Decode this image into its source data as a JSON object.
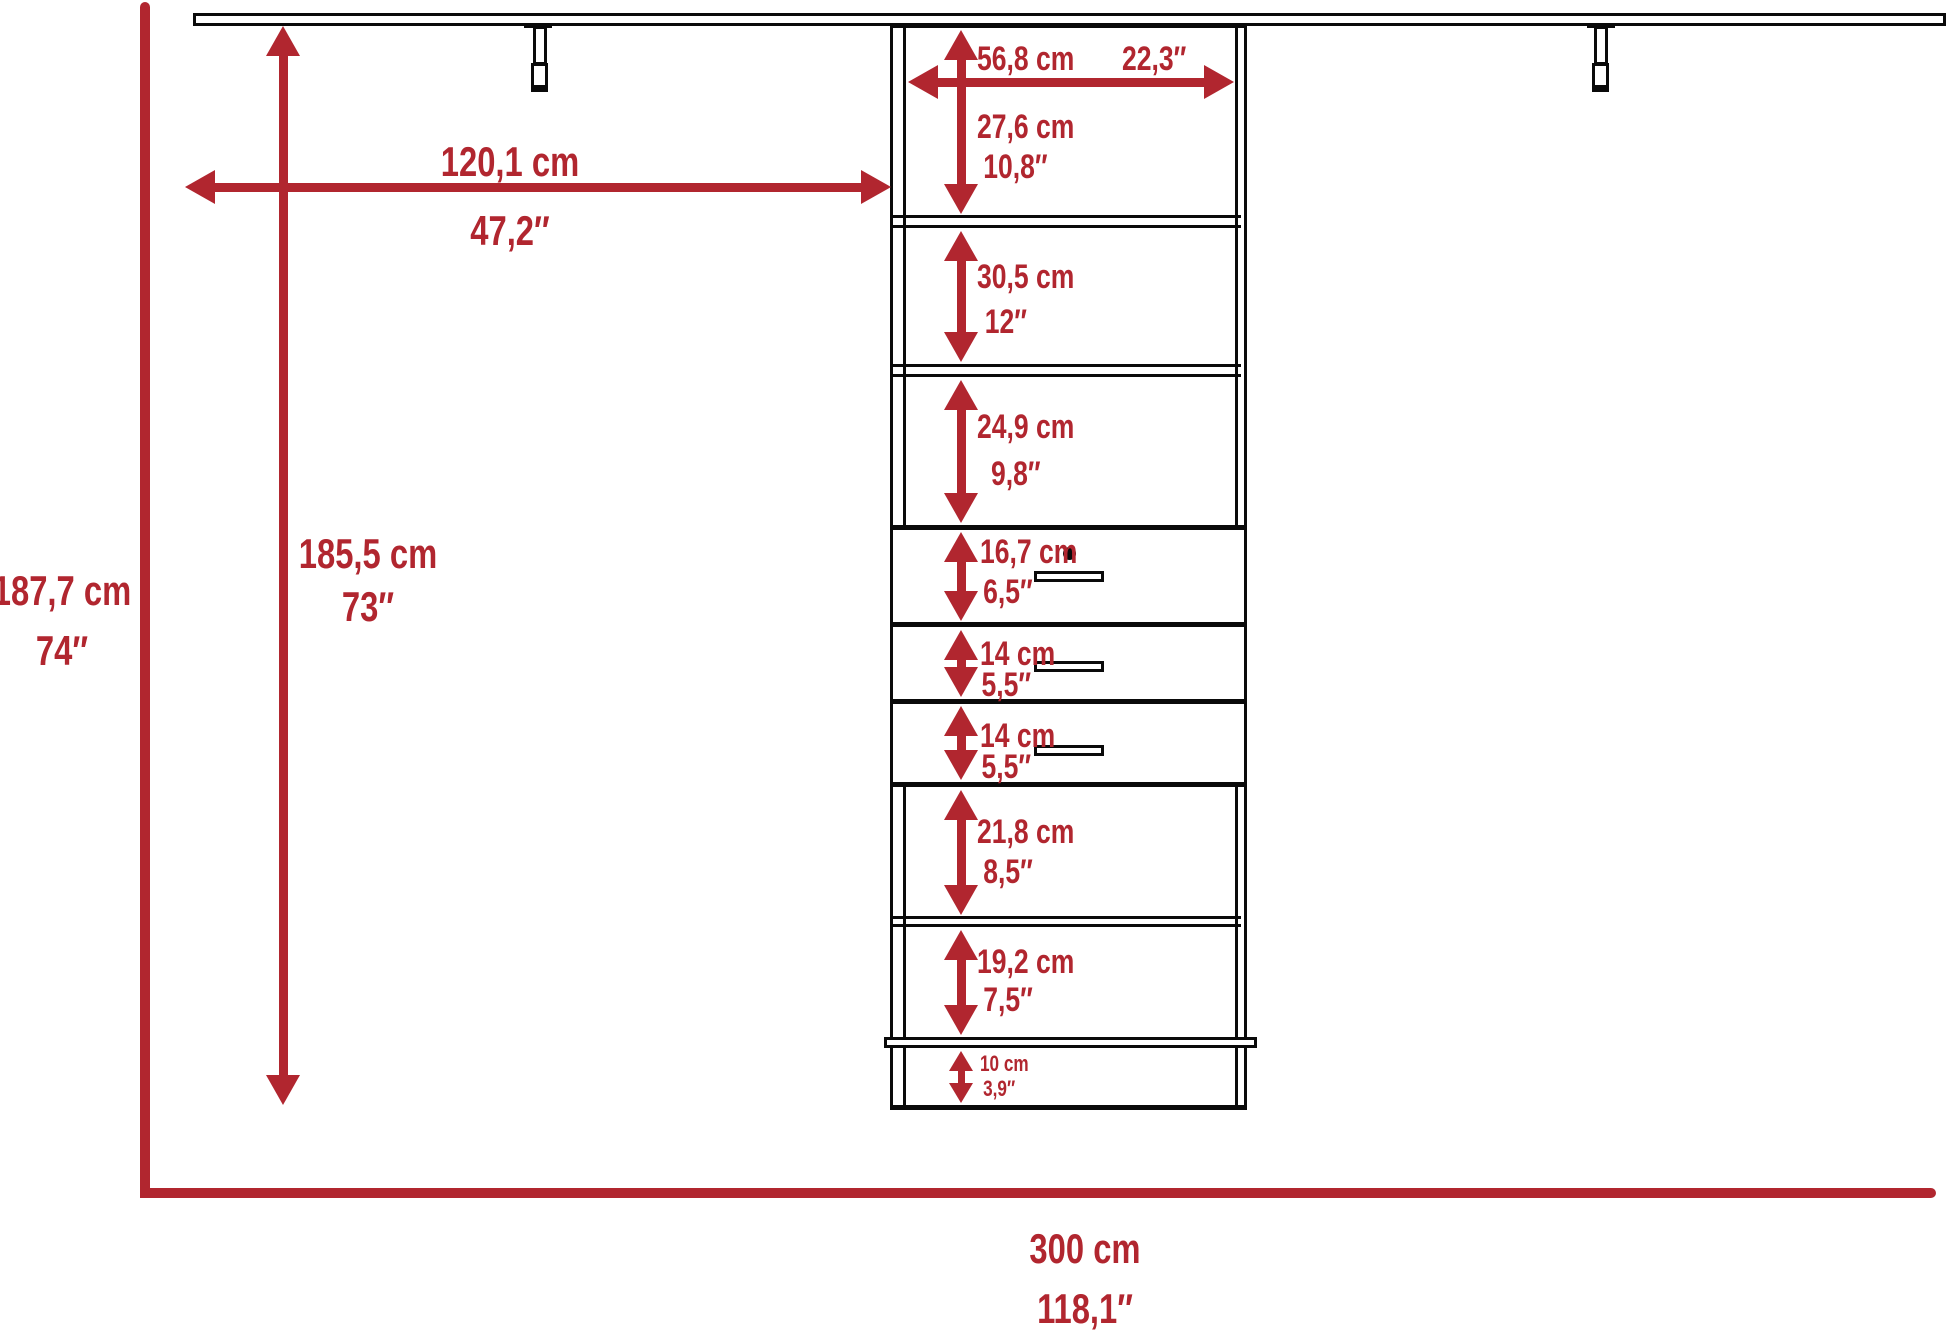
{
  "colors": {
    "dimension_red": "#B1262F",
    "structure_black": "#0A0A0A"
  },
  "overall": {
    "height_cm": "187,7 cm",
    "height_in": "74″",
    "interior_height_cm": "185,5 cm",
    "interior_height_in": "73″",
    "left_section_width_cm": "120,1 cm",
    "left_section_width_in": "47,2″",
    "total_width_cm": "300 cm",
    "total_width_in": "118,1″",
    "tower_width_cm": "56,8 cm",
    "tower_width_in": "22,3″"
  },
  "tower_sections": [
    {
      "name": "shelf-1",
      "cm": "27,6 cm",
      "in": "10,8″"
    },
    {
      "name": "shelf-2",
      "cm": "30,5 cm",
      "in": "12″"
    },
    {
      "name": "shelf-3",
      "cm": "24,9 cm",
      "in": "9,8″"
    },
    {
      "name": "drawer-1",
      "cm": "16,7 cm",
      "in": "6,5″"
    },
    {
      "name": "drawer-2",
      "cm": "14 cm",
      "in": "5,5″"
    },
    {
      "name": "drawer-3",
      "cm": "14 cm",
      "in": "5,5″"
    },
    {
      "name": "shelf-4",
      "cm": "21,8 cm",
      "in": "8,5″"
    },
    {
      "name": "shelf-5",
      "cm": "19,2 cm",
      "in": "7,5″"
    },
    {
      "name": "base",
      "cm": "10 cm",
      "in": "3,9″"
    }
  ]
}
